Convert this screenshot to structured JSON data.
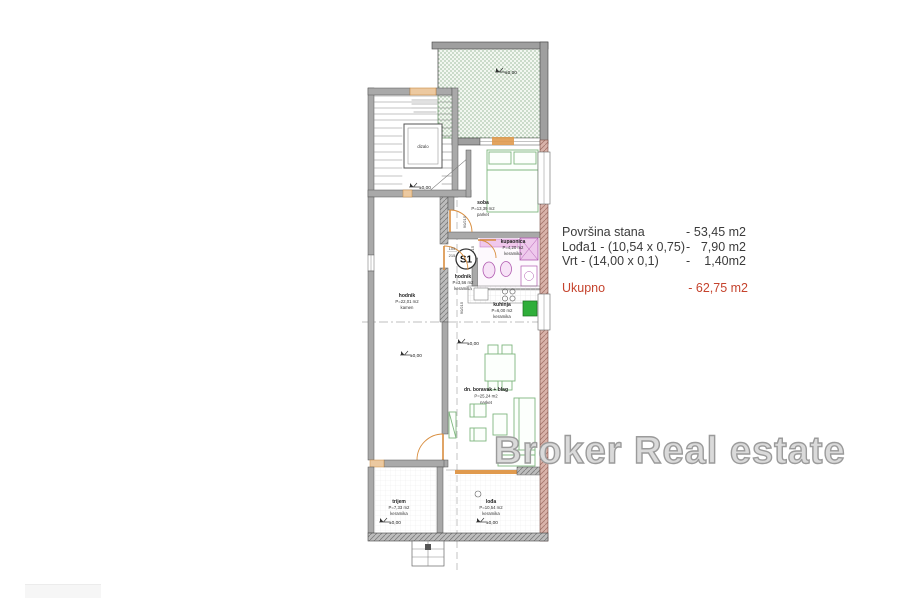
{
  "colors": {
    "total_red": "#c5432d",
    "terrace_green": "#76a078",
    "furniture_green": "#7fb77f",
    "door_orange": "#e09a4e",
    "bath_pink": "#c070c0",
    "wall_pink": "#d9b3aa"
  },
  "summary": {
    "rows": [
      {
        "label": "Površina stana",
        "dash": "-",
        "value": "53,45 m2"
      },
      {
        "label": "Lođa1 - (10,54 x 0,75)",
        "dash": "-",
        "value": "7,90 m2"
      },
      {
        "label": "Vrt - (14,00 x 0,1)",
        "dash": "-",
        "value": "1,40m2"
      }
    ],
    "total_label": "Ukupno",
    "total_value": "- 62,75 m2"
  },
  "watermark": "Broker Real estate",
  "plan": {
    "unit": "S1",
    "elevator": "dizalo",
    "level": "±0,00",
    "rooms": {
      "soba": {
        "name": "soba",
        "area": "P=13,39 m2",
        "floor": "parket"
      },
      "kupaonica": {
        "name": "kupaonica",
        "area": "P=4,20 m2",
        "floor": "keramika"
      },
      "hodnik_stan": {
        "name": "hodnik",
        "area": "P=3,56 m2",
        "floor": "keramika"
      },
      "kuhinja": {
        "name": "kuhinja",
        "area": "P=6,00 m2",
        "floor": "keramika"
      },
      "hodnik": {
        "name": "hodnik",
        "area": "P=22,01 m2",
        "floor": "kamen"
      },
      "boravak": {
        "name": "dn. boravak + blag",
        "area": "P=25,24 m2",
        "floor": "parket"
      },
      "trijem": {
        "name": "trijem",
        "area": "P=7,33 m2",
        "floor": "keramika"
      },
      "loda": {
        "name": "lođa",
        "area": "P=10,54 m2",
        "floor": "keramika"
      }
    },
    "doors": {
      "soba": "90/215",
      "kupaonica": "60/215",
      "dnevni": "90/215",
      "ulaz_w": "105",
      "ulaz_h": "215"
    }
  }
}
